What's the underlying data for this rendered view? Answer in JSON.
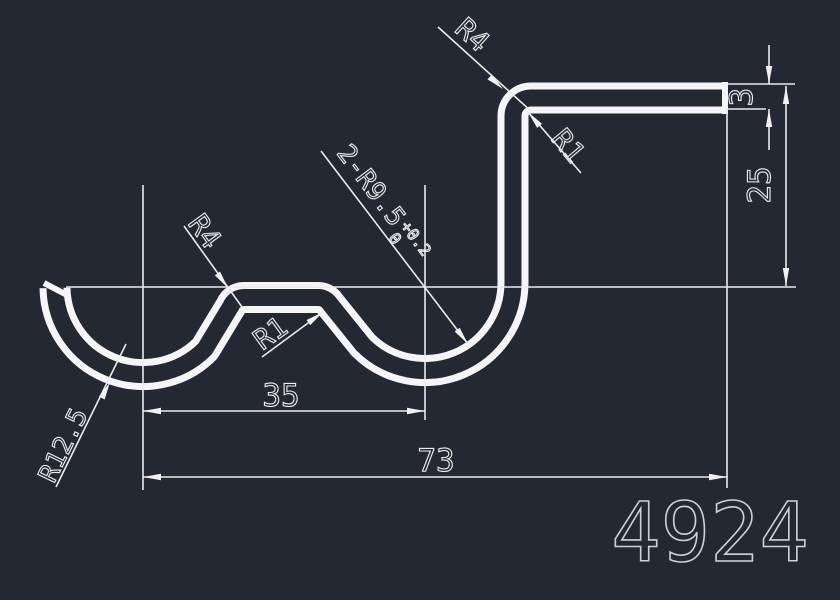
{
  "drawing": {
    "background_color": "#222933",
    "geometry_color": "#f4f5f6",
    "dimension_color": "#e9ebed",
    "part_number": "4924",
    "labels": {
      "radius_top_outer": "R4",
      "radius_top_inner": "R1",
      "radius_mid_outer": "R4",
      "radius_mid_inner": "R1",
      "radius_left_hook": "R12.5",
      "double_radius_prefix": "2-R9.5",
      "double_radius_tol_upper": "+0.2",
      "double_radius_tol_lower": "0"
    },
    "dimensions": {
      "width_inner": "35",
      "width_total": "73",
      "height_right": "25",
      "thickness": "3"
    }
  }
}
